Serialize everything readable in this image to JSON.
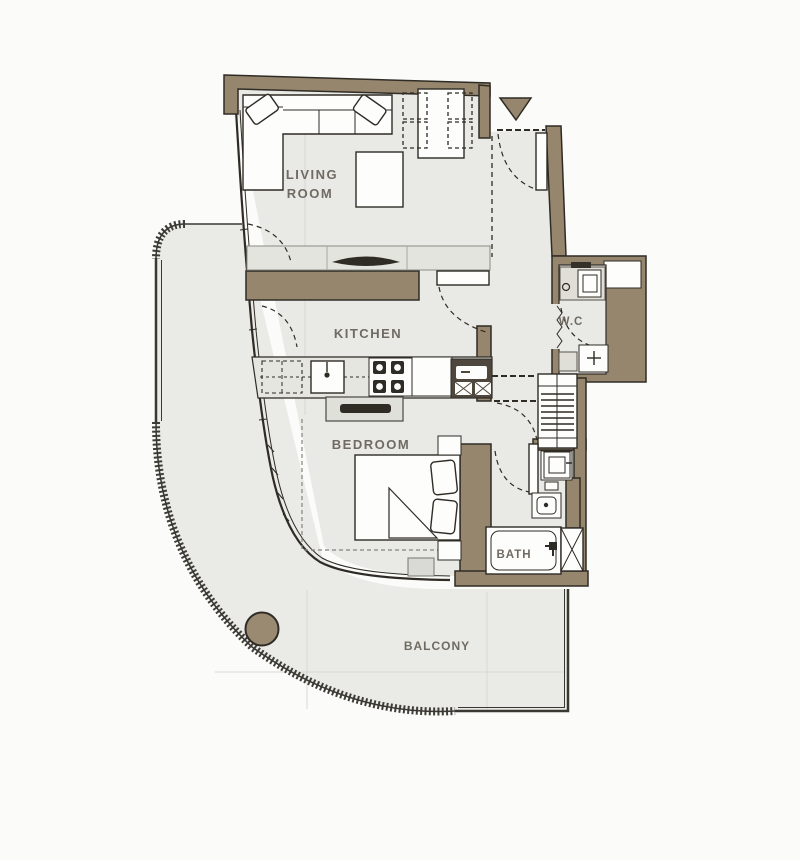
{
  "title": "Two-room apartment floor plan",
  "colors": {
    "background": "#fbfbf9",
    "wall": "#96866e",
    "line": "#2f2b25",
    "floor": "#e9e9e5",
    "balcony_floor": "#eaeae6",
    "fixture": "#fdfdfb",
    "gray_fixture": "#dfdfd8",
    "dark_appliance": "#4e473e",
    "column": "#9b8a72",
    "label": "#6f6b63"
  },
  "rooms": {
    "living_room_line1": "LIVING",
    "living_room_line2": "ROOM",
    "kitchen": "KITCHEN",
    "bedroom": "BEDROOM",
    "wc": "W.C",
    "bath": "BATH",
    "balcony": "BALCONY"
  },
  "icons": {
    "entry_marker": "triangle-down",
    "shaft": "x-box",
    "stove": "four-burners",
    "closet": "hanger-stripes"
  }
}
